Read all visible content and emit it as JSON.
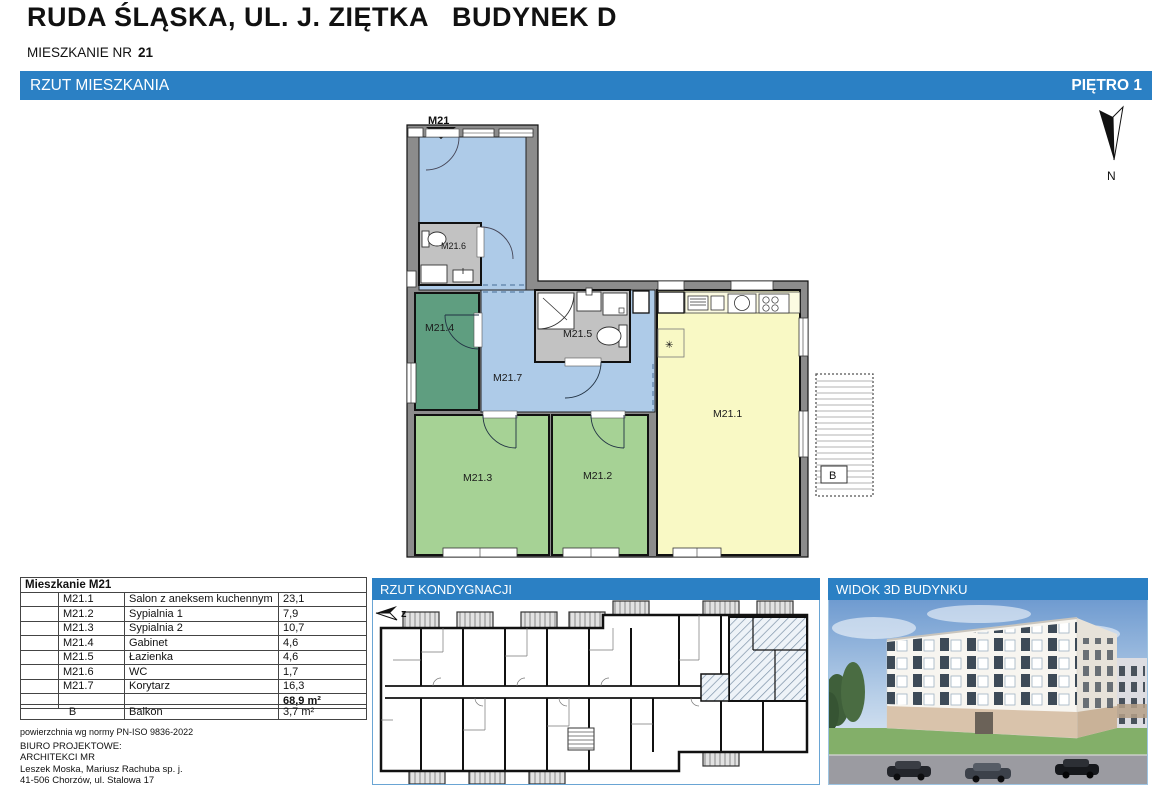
{
  "page": {
    "title": "RUDA ŚLĄSKA, UL. J. ZIĘTKA   BUDYNEK D",
    "apartment_label": "MIESZKANIE NR",
    "apartment_number": "21"
  },
  "plan_header": {
    "left": "RZUT MIESZKANIA",
    "right": "PIĘTRO 1"
  },
  "north_label": "N",
  "colors": {
    "accent_blue": "#2b80c4",
    "corridor_blue": "#aecbe8",
    "office_green": "#5f9e80",
    "bedroom_green": "#a6d295",
    "living_yellow": "#f9f9c5",
    "bath_gray": "#c2c2c2",
    "wall_gray": "#8c8c8c"
  },
  "plan": {
    "entrance_label": "M21",
    "star_symbol": "✳",
    "balcony_label": "B",
    "rooms": [
      {
        "label": "M21.1"
      },
      {
        "label": "M21.2"
      },
      {
        "label": "M21.3"
      },
      {
        "label": "M21.4"
      },
      {
        "label": "M21.5"
      },
      {
        "label": "M21.6"
      },
      {
        "label": "M21.7"
      }
    ]
  },
  "area_table": {
    "title": "Mieszkanie M21",
    "rows": [
      {
        "code": "M21.1",
        "name": "Salon z aneksem kuchennym",
        "area": "23,1"
      },
      {
        "code": "M21.2",
        "name": "Sypialnia 1",
        "area": "7,9"
      },
      {
        "code": "M21.3",
        "name": "Sypialnia 2",
        "area": "10,7"
      },
      {
        "code": "M21.4",
        "name": "Gabinet",
        "area": "4,6"
      },
      {
        "code": "M21.5",
        "name": "Łazienka",
        "area": "4,6"
      },
      {
        "code": "M21.6",
        "name": "WC",
        "area": "1,7"
      },
      {
        "code": "M21.7",
        "name": "Korytarz",
        "area": "16,3"
      }
    ],
    "total": "68,9 m²"
  },
  "balcony_table": {
    "code": "B",
    "name": "Balkon",
    "area": "3,7 m²"
  },
  "norm_note": "powierzchnia wg normy PN-ISO 9836-2022",
  "office_info": [
    "BIURO PROJEKTOWE:",
    "ARCHITEKCI MR",
    "Leszek Moska, Mariusz Rachuba sp. j.",
    "41-506 Chorzów, ul. Stalowa 17",
    "tel. 032 307 05 48."
  ],
  "panels": {
    "floor_plan_title": "RZUT KONDYGNACJI",
    "floor_arrow_label": "z",
    "view3d_title": "WIDOK 3D BUDYNKU"
  }
}
